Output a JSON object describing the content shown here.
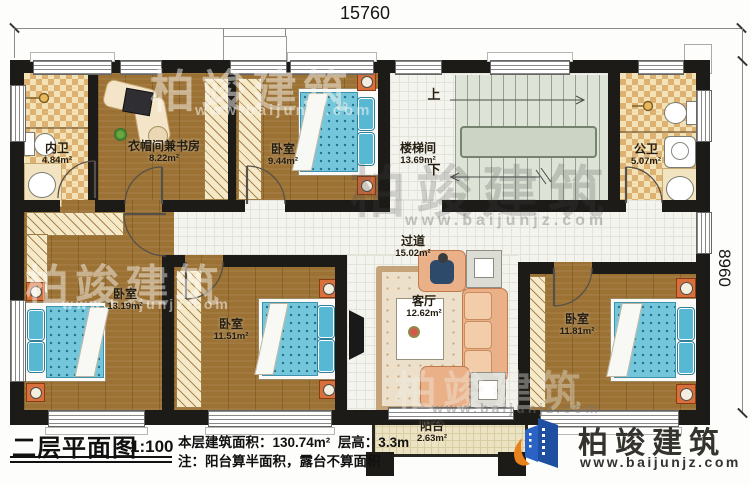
{
  "dimensions": {
    "top": "15760",
    "right": "8960"
  },
  "rooms": [
    {
      "id": "inner-bath",
      "name": "内卫",
      "area": "4.84m²"
    },
    {
      "id": "cloak-study",
      "name": "衣帽间兼书房",
      "area": "8.22m²"
    },
    {
      "id": "bedroom-top",
      "name": "卧室",
      "area": "9.44m²"
    },
    {
      "id": "stairwell",
      "name": "楼梯间",
      "area": "13.69m²"
    },
    {
      "id": "public-bath",
      "name": "公卫",
      "area": "5.07m²"
    },
    {
      "id": "corridor",
      "name": "过道",
      "area": "15.02m²"
    },
    {
      "id": "bedroom-left",
      "name": "卧室",
      "area": "13.19m²"
    },
    {
      "id": "bedroom-mid",
      "name": "卧室",
      "area": "11.51m²"
    },
    {
      "id": "living-room",
      "name": "客厅",
      "area": "12.62m²"
    },
    {
      "id": "bedroom-right",
      "name": "卧室",
      "area": "11.81m²"
    },
    {
      "id": "balcony",
      "name": "阳台",
      "area": "2.63m²"
    }
  ],
  "stairs": {
    "up": "上",
    "down": "下"
  },
  "titleblock": {
    "title": "二层平面图",
    "scale": "1:100",
    "area_line": "本层建筑面积：130.74m²",
    "height_line": "层高：3.3m",
    "note_line": "注：阳台算半面积，露台不算面积"
  },
  "brand": {
    "name": "柏竣建筑",
    "url": "www.baijunjz.com"
  },
  "watermark": {
    "name": "柏竣建筑",
    "url": "www.baijunjz.com"
  },
  "colors": {
    "wall": "#1d1b18",
    "wood_floor": "#9b7134",
    "bath_tile": "#ddb172",
    "corridor_tile": "#f4f4ee",
    "bed_blue": "#74c6db",
    "stair": "#dde3d6",
    "balcony": "#ece3c3",
    "brand_blue": "#1e4fa1",
    "brand_orange": "#e8821d"
  }
}
